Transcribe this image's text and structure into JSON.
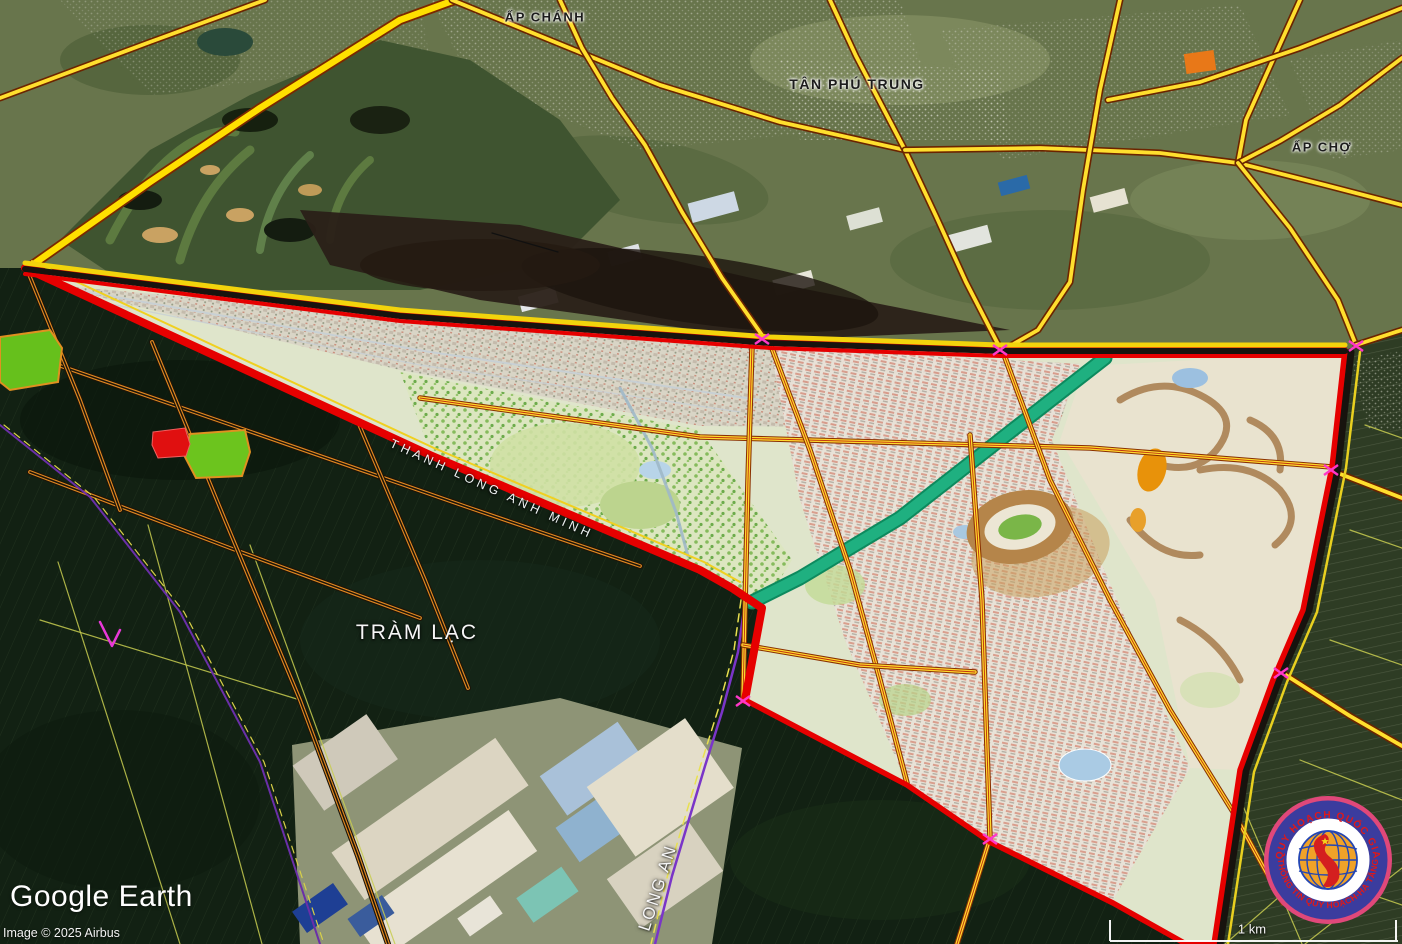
{
  "labels": {
    "ap_chanh": "ẤP CHÁNH",
    "tan_phu_trung": "TÂN PHÚ TRUNG",
    "ap_cho": "ẤP CHỢ",
    "tram_lac": "TRÀM LẠC",
    "long_an": "LONG AN",
    "road_thanh_long": "THANH LONG ANH MINH"
  },
  "attribution": {
    "brand": "Google Earth",
    "imagery": "Image © 2025 Airbus"
  },
  "scale_bar": {
    "label": "1 km"
  },
  "stamp": {
    "arc_top": "QUY HOẠCH QUỐC GIA",
    "arc_bottom": "THÔNG TIN QUY HOẠCH-HẠ TẦNG"
  },
  "colors": {
    "boundary_red": "#e60000",
    "road_yellow": "#ffdf2e",
    "road_casing": "#6b2400",
    "canal_teal": "#1fb080",
    "admin_purple": "#7a35c8",
    "planned_road_orange": "#e08820",
    "parcel_green": "#66c01c",
    "parcel_red": "#e01010"
  }
}
